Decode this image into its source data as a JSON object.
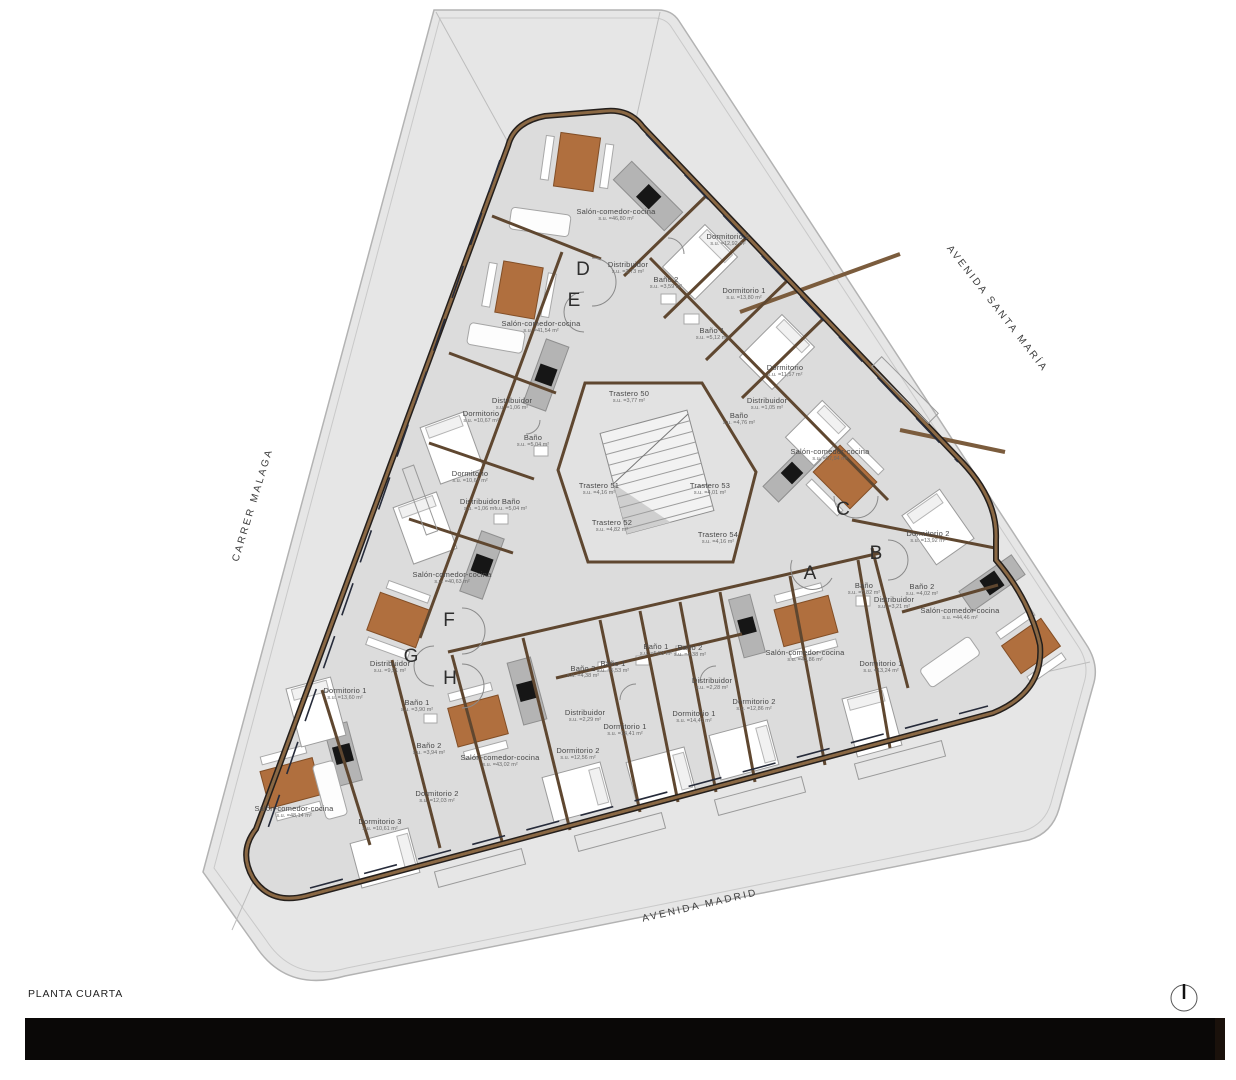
{
  "title": "PLANTA CUARTA",
  "streets": [
    {
      "name": "AVENIDA SANTA MARÍA",
      "x": 997,
      "y": 309,
      "rotation": 52
    },
    {
      "name": "CARRER MALAGA",
      "x": 253,
      "y": 505,
      "rotation": -73
    },
    {
      "name": "AVENIDA MADRID",
      "x": 700,
      "y": 906,
      "rotation": -13
    }
  ],
  "unit_letters": [
    {
      "label": "A",
      "x": 810,
      "y": 574
    },
    {
      "label": "B",
      "x": 876,
      "y": 554
    },
    {
      "label": "C",
      "x": 843,
      "y": 510
    },
    {
      "label": "D",
      "x": 583,
      "y": 270
    },
    {
      "label": "E",
      "x": 574,
      "y": 301
    },
    {
      "label": "F",
      "x": 449,
      "y": 621
    },
    {
      "label": "G",
      "x": 411,
      "y": 657
    },
    {
      "label": "H",
      "x": 450,
      "y": 679
    }
  ],
  "rooms": [
    {
      "name": "Salón-comedor-cocina",
      "area": "s.u. =46,80 m²",
      "x": 616,
      "y": 215
    },
    {
      "name": "Dormitorio 2",
      "area": "s.u. =12,92 m²",
      "x": 728,
      "y": 240
    },
    {
      "name": "Distribuidor",
      "area": "s.u. =3,73 m²",
      "x": 628,
      "y": 268
    },
    {
      "name": "Baño 2",
      "area": "s.u. =3,59 m²",
      "x": 666,
      "y": 283
    },
    {
      "name": "Dormitorio 1",
      "area": "s.u. =13,80 m²",
      "x": 744,
      "y": 294
    },
    {
      "name": "Baño 1",
      "area": "s.u. =5,12 m²",
      "x": 712,
      "y": 334
    },
    {
      "name": "Dormitorio",
      "area": "s.u. =11,57 m²",
      "x": 785,
      "y": 371
    },
    {
      "name": "Distribuidor",
      "area": "s.u. =1,05 m²",
      "x": 767,
      "y": 404
    },
    {
      "name": "Baño",
      "area": "s.u. =4,76 m²",
      "x": 739,
      "y": 419
    },
    {
      "name": "Salón-comedor-cocina",
      "area": "s.u. =57,94 m²",
      "x": 830,
      "y": 455
    },
    {
      "name": "Salón-comedor-cocina",
      "area": "s.u. =41,54 m²",
      "x": 541,
      "y": 327
    },
    {
      "name": "Distribuidor",
      "area": "s.u. =1,06 m²",
      "x": 512,
      "y": 404
    },
    {
      "name": "Dormitorio",
      "area": "s.u. =10,67 m²",
      "x": 481,
      "y": 417
    },
    {
      "name": "Baño",
      "area": "s.u. =5,04 m²",
      "x": 533,
      "y": 441
    },
    {
      "name": "Dormitorio",
      "area": "s.u. =10,67 m²",
      "x": 470,
      "y": 477
    },
    {
      "name": "Distribuidor",
      "area": "s.u. =1,06 m²",
      "x": 480,
      "y": 505
    },
    {
      "name": "Baño",
      "area": "s.u. =5,04 m²",
      "x": 511,
      "y": 505
    },
    {
      "name": "Salón-comedor-cocina",
      "area": "s.u. =40,63 m²",
      "x": 452,
      "y": 578
    },
    {
      "name": "Trastero 50",
      "area": "s.u. =3,77 m²",
      "x": 629,
      "y": 397
    },
    {
      "name": "Trastero 51",
      "area": "s.u. =4,16 m²",
      "x": 599,
      "y": 489
    },
    {
      "name": "Trastero 53",
      "area": "s.u. =4,01 m²",
      "x": 710,
      "y": 489
    },
    {
      "name": "Trastero 52",
      "area": "s.u. =4,82 m²",
      "x": 612,
      "y": 526
    },
    {
      "name": "Trastero 54",
      "area": "s.u. =4,16 m²",
      "x": 718,
      "y": 538
    },
    {
      "name": "Dormitorio 2",
      "area": "s.u. =13,92 m²",
      "x": 928,
      "y": 537
    },
    {
      "name": "Baño",
      "area": "s.u. =5,82 m²",
      "x": 864,
      "y": 589
    },
    {
      "name": "Baño 2",
      "area": "s.u. =4,02 m²",
      "x": 922,
      "y": 590
    },
    {
      "name": "Distribuidor",
      "area": "s.u. =3,21 m²",
      "x": 894,
      "y": 603
    },
    {
      "name": "Salón-comedor-cocina",
      "area": "s.u. =44,46 m²",
      "x": 960,
      "y": 614
    },
    {
      "name": "Dormitorio 1",
      "area": "s.u. =13,24 m²",
      "x": 881,
      "y": 667
    },
    {
      "name": "Salón-comedor-cocina",
      "area": "s.u. =43,86 m²",
      "x": 805,
      "y": 656
    },
    {
      "name": "Distribuidor",
      "area": "s.u. =2,28 m²",
      "x": 712,
      "y": 684
    },
    {
      "name": "Dormitorio 1",
      "area": "s.u. =14,41 m²",
      "x": 694,
      "y": 717
    },
    {
      "name": "Dormitorio 2",
      "area": "s.u. =12,86 m²",
      "x": 754,
      "y": 705
    },
    {
      "name": "Baño 1",
      "area": "s.u. =5,53 m²",
      "x": 656,
      "y": 650
    },
    {
      "name": "Baño 2",
      "area": "s.u. =4,38 m²",
      "x": 690,
      "y": 651
    },
    {
      "name": "Baño 1",
      "area": "s.u. =5,53 m²",
      "x": 613,
      "y": 667
    },
    {
      "name": "Baño 2",
      "area": "s.u. =4,38 m²",
      "x": 583,
      "y": 672
    },
    {
      "name": "Distribuidor",
      "area": "s.u. =2,29 m²",
      "x": 585,
      "y": 716
    },
    {
      "name": "Dormitorio 1",
      "area": "s.u. =14,41 m²",
      "x": 625,
      "y": 730
    },
    {
      "name": "Dormitorio 2",
      "area": "s.u. =12,56 m²",
      "x": 578,
      "y": 754
    },
    {
      "name": "Salón-comedor-cocina",
      "area": "s.u. =43,02 m²",
      "x": 500,
      "y": 761
    },
    {
      "name": "Dormitorio 2",
      "area": "s.u. =12,03 m²",
      "x": 437,
      "y": 797
    },
    {
      "name": "Distribuidor",
      "area": "s.u. =9,51 m²",
      "x": 390,
      "y": 667
    },
    {
      "name": "Dormitorio 1",
      "area": "s.u. =13,60 m²",
      "x": 345,
      "y": 694
    },
    {
      "name": "Baño 1",
      "area": "s.u. =3,90 m²",
      "x": 417,
      "y": 706
    },
    {
      "name": "Baño 2",
      "area": "s.u. =3,94 m²",
      "x": 429,
      "y": 749
    },
    {
      "name": "Salón-comedor-cocina",
      "area": "s.u. =48,14 m²",
      "x": 294,
      "y": 812
    },
    {
      "name": "Dormitorio 3",
      "area": "s.u. =10,61 m²",
      "x": 380,
      "y": 825
    }
  ],
  "colors": {
    "site": "#e6e6e6",
    "floor": "#dcdcdc",
    "wall": "#8a6844",
    "wall_dark": "#241f1c",
    "table": "#b06f3e",
    "footer_bar": "#0a0807"
  }
}
